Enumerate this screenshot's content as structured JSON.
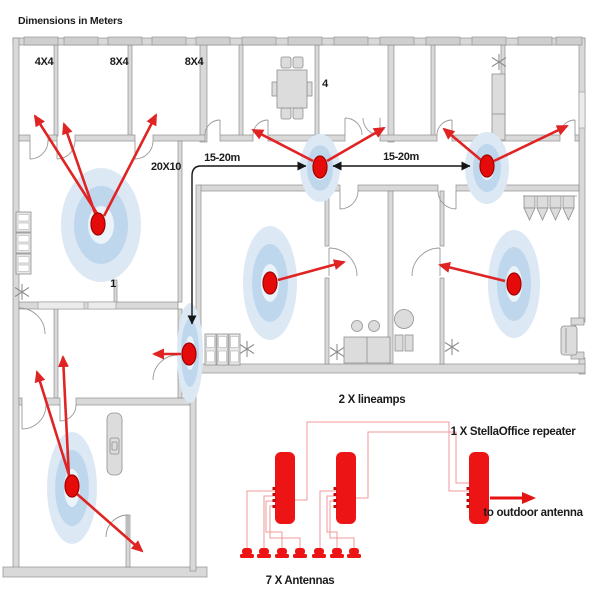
{
  "title": "Dimensions in Meters",
  "floorplan": {
    "room_labels": {
      "small_room": "4X4",
      "mid_room_a": "8X4",
      "mid_room_b": "8X4",
      "meeting_room": "4",
      "open_office": "20X10",
      "open_office_antenna": "1"
    },
    "distance_label_left": "15-20m",
    "distance_label_right": "15-20m"
  },
  "schematic": {
    "lineamps_label": "2 X lineamps",
    "repeater_label": "1 X StellaOffice repeater",
    "outdoor_label": "to outdoor antenna",
    "antennas_label": "7 X Antennas"
  },
  "colors": {
    "antenna_red": "#e50b0b",
    "arrow_red": "#e02424",
    "device_red": "#ec1414",
    "wire_red": "#f09a9a",
    "wall_gray": "#d9d9d9",
    "glow_outer": "#dce9f5",
    "glow_mid": "#bfd7ed",
    "glow_inner": "#eaf2fa",
    "text": "#1b1b1b"
  }
}
